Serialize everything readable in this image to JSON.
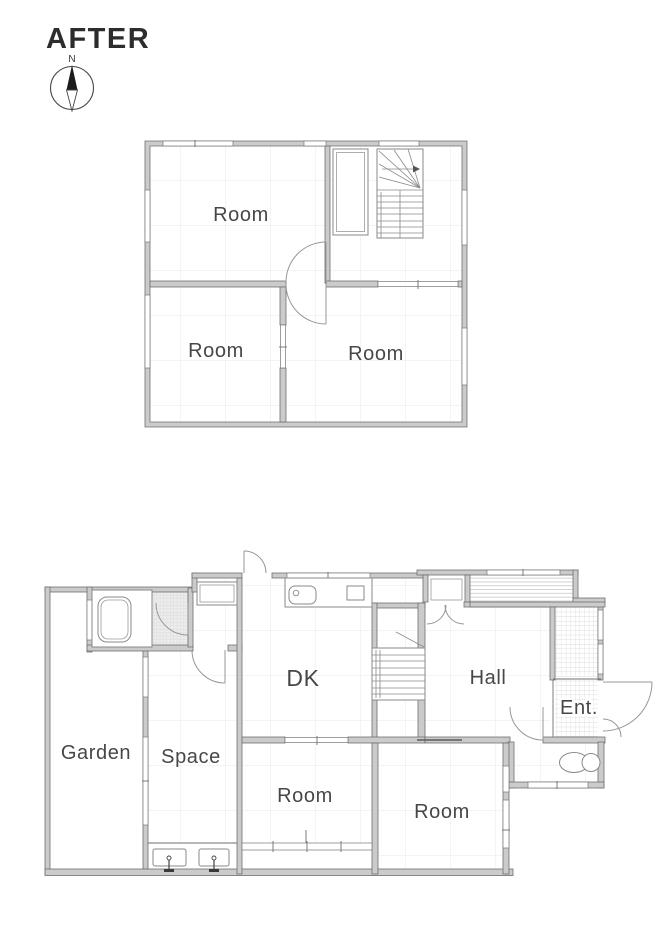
{
  "title": "AFTER",
  "compass": {
    "north": "N"
  },
  "colors": {
    "wall_fill": "#cbcbcb",
    "wall_stroke": "#6f6f6f",
    "door_line": "#979797",
    "label_text": "#474747",
    "grid_line": "#e8e8e8",
    "washroom_hatch": "#d9d9d9"
  },
  "floor2": {
    "rooms": [
      {
        "label": "Room"
      },
      {
        "label": "Room"
      },
      {
        "label": "Room"
      }
    ]
  },
  "floor1": {
    "rooms": [
      {
        "label": "Garden"
      },
      {
        "label": "Space"
      },
      {
        "label": "DK"
      },
      {
        "label": "Hall"
      },
      {
        "label": "Ent."
      },
      {
        "label": "Room"
      },
      {
        "label": "Room"
      }
    ]
  }
}
